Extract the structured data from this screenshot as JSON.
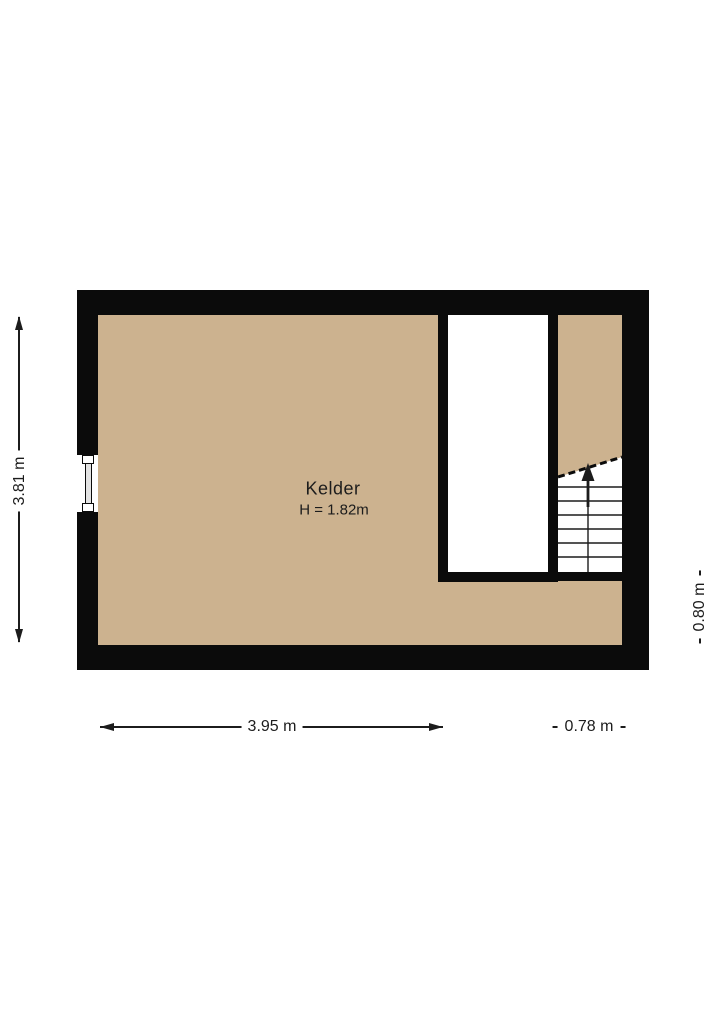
{
  "room": {
    "name": "Kelder",
    "ceiling_height": "H = 1.82m"
  },
  "dimensions": {
    "height_main": "3.81 m",
    "width_main": "3.95 m",
    "width_stairs": "0.78 m",
    "height_stairs": "0.80 m"
  },
  "icons": {
    "stairs_direction": "up-arrow"
  },
  "colors": {
    "background": "#ffffff",
    "wall": "#0b0b0b",
    "floor": "#ccb28f",
    "opening": "#ffffff",
    "line": "#1c1c1c",
    "glazing": "#e3e3e3"
  }
}
